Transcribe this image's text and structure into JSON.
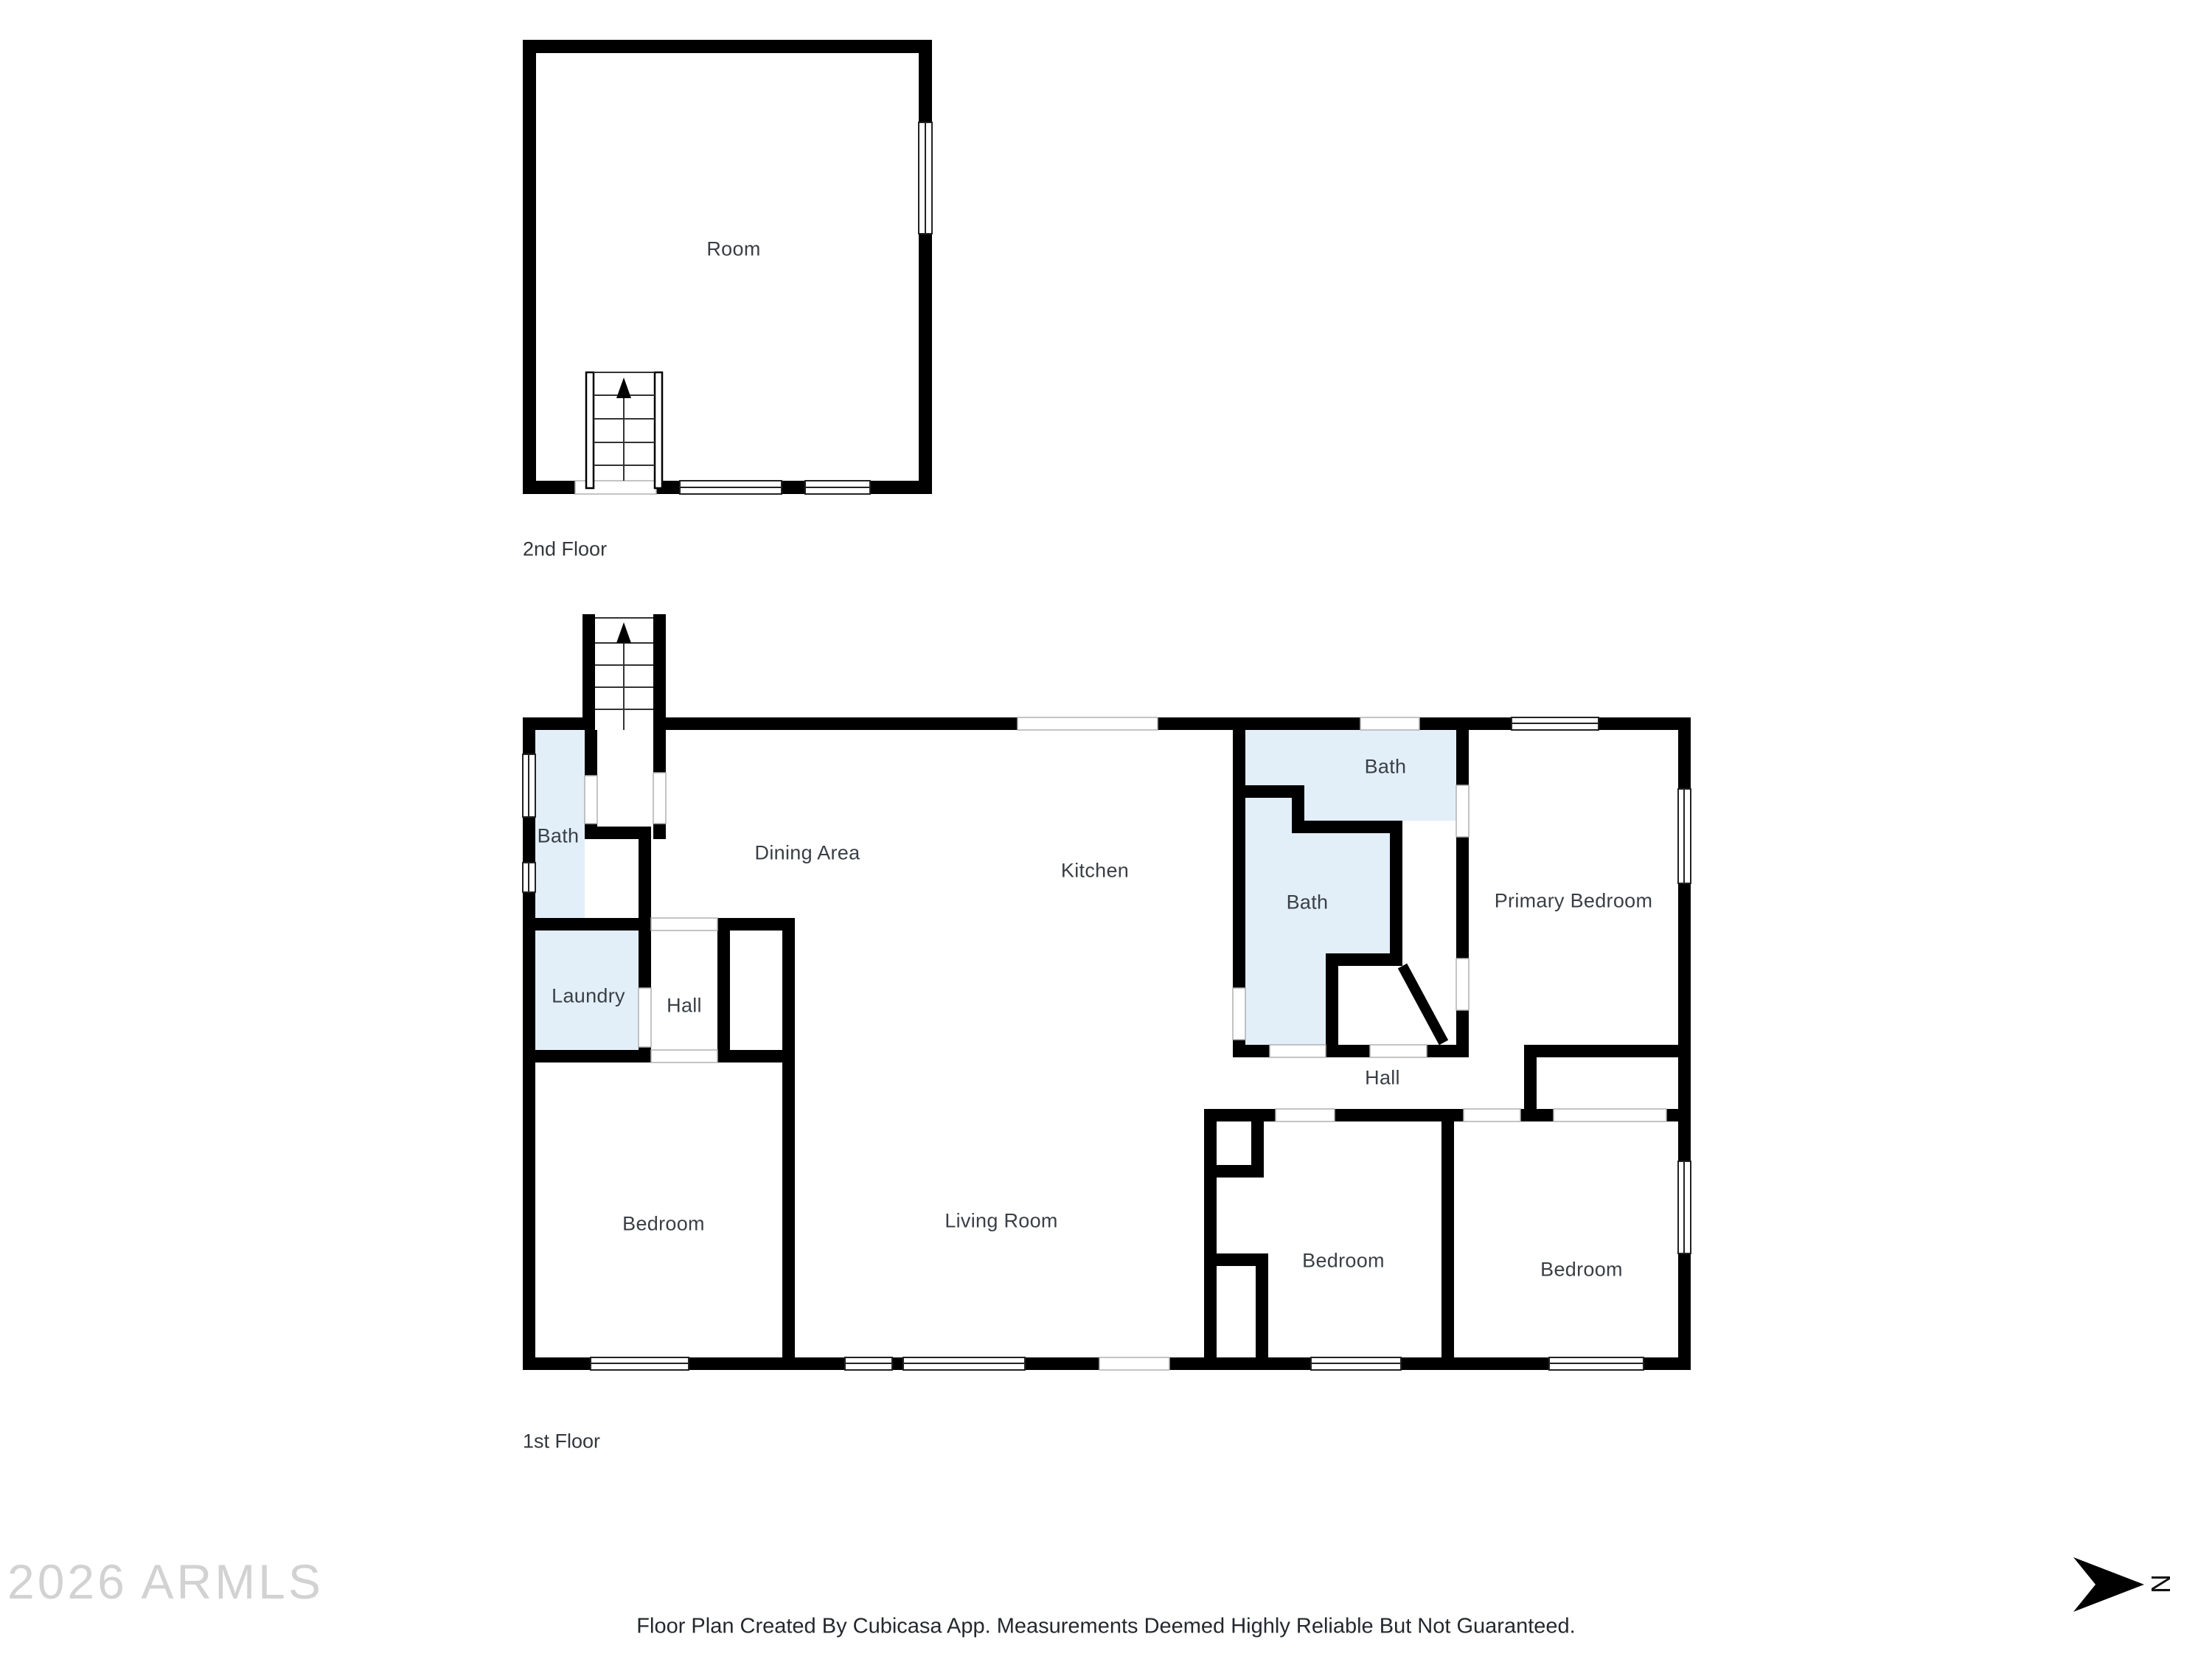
{
  "floors": {
    "second": {
      "caption": "2nd Floor",
      "rooms": [
        {
          "label": "Room"
        }
      ]
    },
    "first": {
      "caption": "1st Floor",
      "rooms": [
        {
          "label": "Bath"
        },
        {
          "label": "Dining Area"
        },
        {
          "label": "Kitchen"
        },
        {
          "label": "Bath"
        },
        {
          "label": "Bath"
        },
        {
          "label": "Primary Bedroom"
        },
        {
          "label": "Laundry"
        },
        {
          "label": "Hall"
        },
        {
          "label": "Hall"
        },
        {
          "label": "Bedroom"
        },
        {
          "label": "Living Room"
        },
        {
          "label": "Bedroom"
        },
        {
          "label": "Bedroom"
        }
      ]
    }
  },
  "watermark": "2026 ARMLS",
  "footer": {
    "disclaimer": "Floor Plan Created By Cubicasa App. Measurements Deemed Highly Reliable But Not Guaranteed."
  },
  "compass": {
    "north_label": "N"
  },
  "colors": {
    "wall": "#000000",
    "bath_fill": "#e2eff9",
    "label_text": "#3a3f46",
    "watermark_text": "#d2d2d2",
    "door_frame_line": "#b0b0b0"
  }
}
